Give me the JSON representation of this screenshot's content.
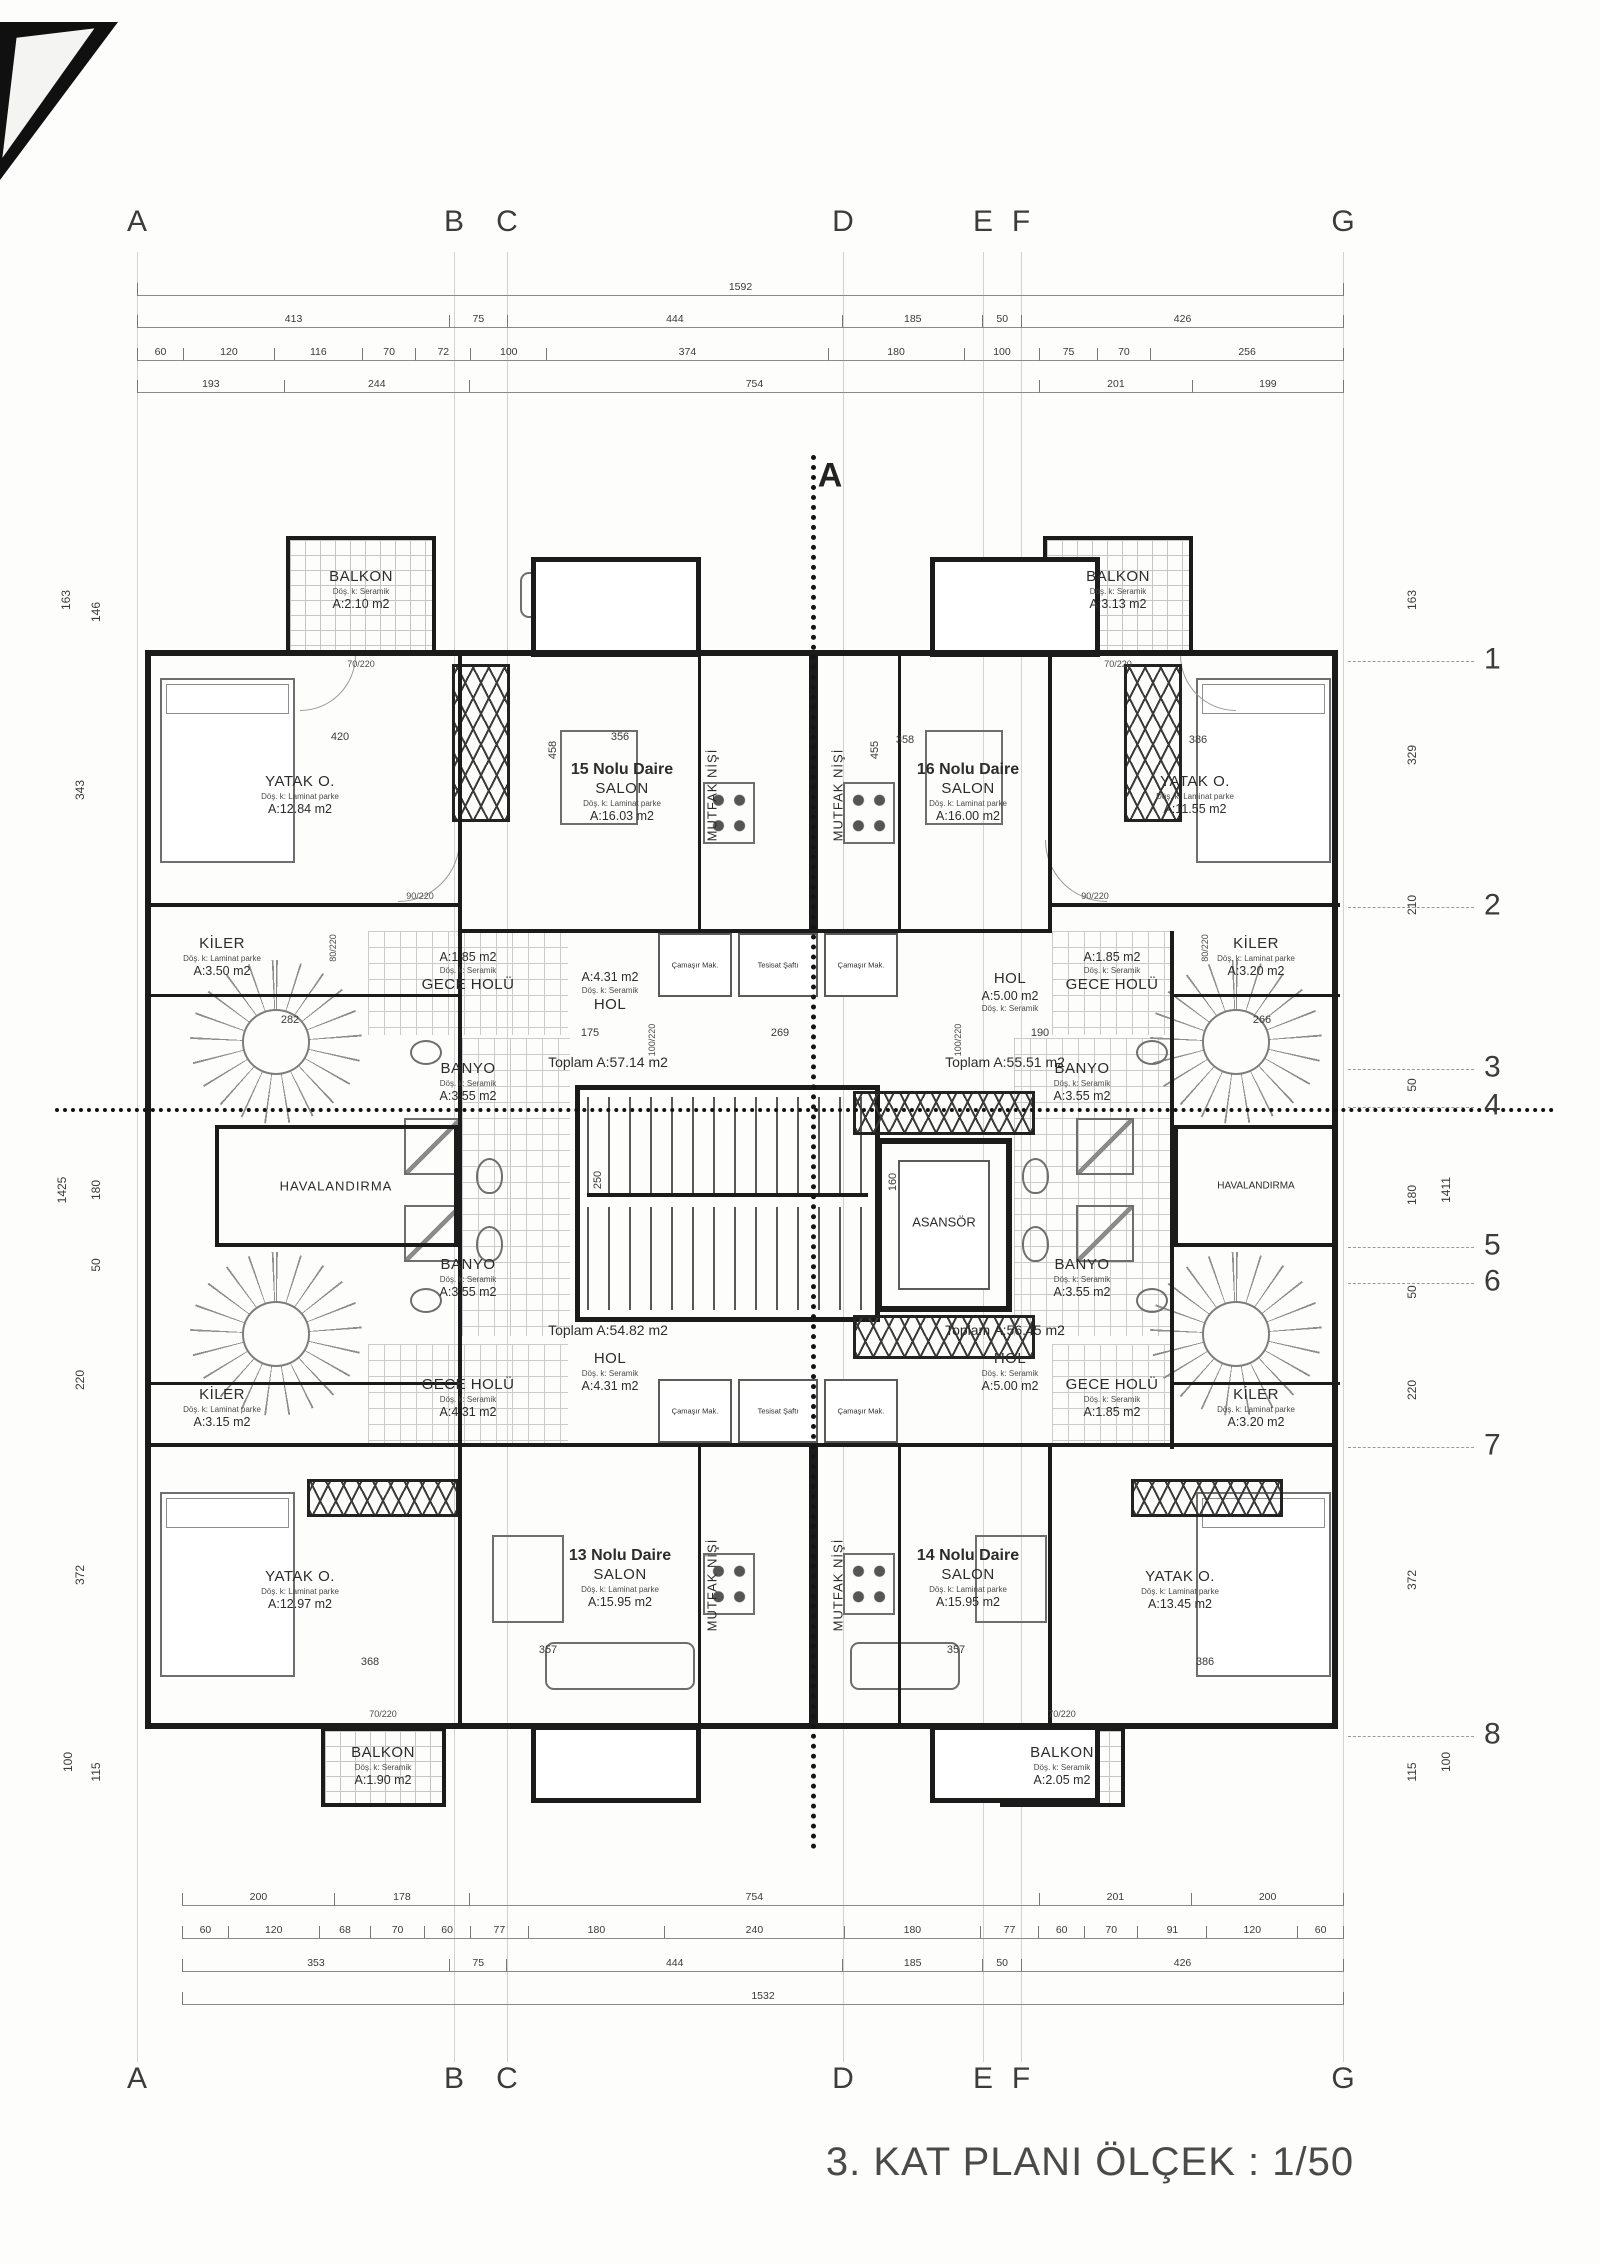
{
  "title": "3. KAT PLANI ÖLÇEK : 1/50",
  "section_marker": "A",
  "grid": {
    "columns": [
      "A",
      "B",
      "C",
      "D",
      "E",
      "F",
      "G"
    ],
    "rows": [
      "1",
      "2",
      "3",
      "4",
      "5",
      "6",
      "7",
      "8"
    ]
  },
  "dimensions": {
    "top": [
      [
        "1592"
      ],
      [
        "413",
        "75",
        "444",
        "185",
        "50",
        "426"
      ],
      [
        "60",
        "120",
        "116",
        "70",
        "72",
        "100",
        "374",
        "180",
        "100",
        "75",
        "70",
        "256"
      ],
      [
        "193",
        "244",
        "754",
        "201",
        "199"
      ]
    ],
    "bottom": [
      [
        "200",
        "178",
        "754",
        "201",
        "200"
      ],
      [
        "60",
        "120",
        "68",
        "70",
        "60",
        "77",
        "180",
        "240",
        "180",
        "77",
        "60",
        "70",
        "91",
        "120",
        "60"
      ],
      [
        "353",
        "75",
        "444",
        "185",
        "50",
        "426"
      ],
      [
        "1532"
      ]
    ],
    "left": [
      "163",
      "146",
      "343",
      "1425",
      "180",
      "50",
      "220",
      "372",
      "115",
      "100"
    ],
    "right": [
      "163",
      "329",
      "210",
      "50",
      "180",
      "1411",
      "50",
      "220",
      "372",
      "115",
      "100"
    ]
  },
  "inner_dims": {
    "d420": "420",
    "d356": "356",
    "d358": "358",
    "d386": "386",
    "d458": "458",
    "d455": "455",
    "d175": "175",
    "d269": "269",
    "d190": "190",
    "d282": "282",
    "d266": "266",
    "d250": "250",
    "d160": "160",
    "d357": "357",
    "d368": "368"
  },
  "doors": {
    "d70": "70/220",
    "d80": "80/220",
    "d90": "90/220",
    "d100": "100/220"
  },
  "labels": {
    "havalandirma": "HAVALANDIRMA",
    "asansor": "ASANSÖR",
    "mutfak": "MUTFAK NİŞİ",
    "camasir": "Çamaşır Mak.",
    "tesisat": "Tesisat Şaftı",
    "toplam_15": "Toplam A:57.14 m2",
    "toplam_16": "Toplam A:55.51 m2",
    "toplam_13": "Toplam A:54.82 m2",
    "toplam_14": "Toplam A:56.45 m2"
  },
  "rooms": {
    "balkon_tl": {
      "lines": [
        {
          "t": "BALKON",
          "s": "name"
        },
        {
          "t": "Döş. k: Seramik",
          "s": "note"
        },
        {
          "t": "A:2.10 m2",
          "s": "area"
        }
      ]
    },
    "balkon_tr": {
      "lines": [
        {
          "t": "BALKON",
          "s": "name"
        },
        {
          "t": "Döş. k: Seramik",
          "s": "note"
        },
        {
          "t": "A:3.13 m2",
          "s": "area"
        }
      ]
    },
    "balkon_bl": {
      "lines": [
        {
          "t": "BALKON",
          "s": "name"
        },
        {
          "t": "Döş. k: Seramik",
          "s": "note"
        },
        {
          "t": "A:1.90 m2",
          "s": "area"
        }
      ]
    },
    "balkon_br": {
      "lines": [
        {
          "t": "BALKON",
          "s": "name"
        },
        {
          "t": "Döş. k: Seramik",
          "s": "note"
        },
        {
          "t": "A:2.05 m2",
          "s": "area"
        }
      ]
    },
    "yatak_15": {
      "lines": [
        {
          "t": "YATAK O.",
          "s": "name"
        },
        {
          "t": "Döş. k: Laminat parke",
          "s": "note"
        },
        {
          "t": "A:12.84 m2",
          "s": "area"
        }
      ]
    },
    "yatak_16": {
      "lines": [
        {
          "t": "YATAK O.",
          "s": "name"
        },
        {
          "t": "Döş. k: Laminat parke",
          "s": "note"
        },
        {
          "t": "A:11.55 m2",
          "s": "area"
        }
      ]
    },
    "yatak_13": {
      "lines": [
        {
          "t": "YATAK O.",
          "s": "name"
        },
        {
          "t": "Döş. k: Laminat parke",
          "s": "note"
        },
        {
          "t": "A:12.97 m2",
          "s": "area"
        }
      ]
    },
    "yatak_14": {
      "lines": [
        {
          "t": "YATAK O.",
          "s": "name"
        },
        {
          "t": "Döş. k: Laminat parke",
          "s": "note"
        },
        {
          "t": "A:13.45 m2",
          "s": "area"
        }
      ]
    },
    "salon_15": {
      "lines": [
        {
          "t": "15 Nolu Daire",
          "s": "unit"
        },
        {
          "t": "SALON",
          "s": "name"
        },
        {
          "t": "Döş. k: Laminat parke",
          "s": "note"
        },
        {
          "t": "A:16.03 m2",
          "s": "area"
        }
      ]
    },
    "salon_16": {
      "lines": [
        {
          "t": "16 Nolu Daire",
          "s": "unit"
        },
        {
          "t": "SALON",
          "s": "name"
        },
        {
          "t": "Döş. k: Laminat parke",
          "s": "note"
        },
        {
          "t": "A:16.00 m2",
          "s": "area"
        }
      ]
    },
    "salon_13": {
      "lines": [
        {
          "t": "13 Nolu Daire",
          "s": "unit"
        },
        {
          "t": "SALON",
          "s": "name"
        },
        {
          "t": "Döş. k: Laminat parke",
          "s": "note"
        },
        {
          "t": "A:15.95 m2",
          "s": "area"
        }
      ]
    },
    "salon_14": {
      "lines": [
        {
          "t": "14 Nolu Daire",
          "s": "unit"
        },
        {
          "t": "SALON",
          "s": "name"
        },
        {
          "t": "Döş. k: Laminat parke",
          "s": "note"
        },
        {
          "t": "A:15.95 m2",
          "s": "area"
        }
      ]
    },
    "kiler_15": {
      "lines": [
        {
          "t": "KİLER",
          "s": "name"
        },
        {
          "t": "Döş. k: Laminat parke",
          "s": "note"
        },
        {
          "t": "A:3.50 m2",
          "s": "area"
        }
      ]
    },
    "kiler_16": {
      "lines": [
        {
          "t": "KİLER",
          "s": "name"
        },
        {
          "t": "Döş. k: Laminat parke",
          "s": "note"
        },
        {
          "t": "A:3.20 m2",
          "s": "area"
        }
      ]
    },
    "kiler_13": {
      "lines": [
        {
          "t": "KİLER",
          "s": "name"
        },
        {
          "t": "Döş. k: Laminat parke",
          "s": "note"
        },
        {
          "t": "A:3.15 m2",
          "s": "area"
        }
      ]
    },
    "kiler_14": {
      "lines": [
        {
          "t": "KİLER",
          "s": "name"
        },
        {
          "t": "Döş. k: Laminat parke",
          "s": "note"
        },
        {
          "t": "A:3.20 m2",
          "s": "area"
        }
      ]
    },
    "gece_15": {
      "lines": [
        {
          "t": "A:1.85 m2",
          "s": "area"
        },
        {
          "t": "Döş. k: Seramik",
          "s": "note"
        },
        {
          "t": "GECE HOLÜ",
          "s": "name"
        }
      ]
    },
    "gece_16": {
      "lines": [
        {
          "t": "A:1.85 m2",
          "s": "area"
        },
        {
          "t": "Döş. k: Seramik",
          "s": "note"
        },
        {
          "t": "GECE HOLÜ",
          "s": "name"
        }
      ]
    },
    "gece_13": {
      "lines": [
        {
          "t": "GECE HOLÜ",
          "s": "name"
        },
        {
          "t": "Döş. k: Seramik",
          "s": "note"
        },
        {
          "t": "A:4.31 m2",
          "s": "area"
        }
      ]
    },
    "gece_14": {
      "lines": [
        {
          "t": "GECE HOLÜ",
          "s": "name"
        },
        {
          "t": "Döş. k: Seramik",
          "s": "note"
        },
        {
          "t": "A:1.85 m2",
          "s": "area"
        }
      ]
    },
    "hol_15": {
      "lines": [
        {
          "t": "A:4.31 m2",
          "s": "area"
        },
        {
          "t": "Döş. k: Seramik",
          "s": "note"
        },
        {
          "t": "HOL",
          "s": "name"
        }
      ]
    },
    "hol_16": {
      "lines": [
        {
          "t": "HOL",
          "s": "name"
        },
        {
          "t": "A:5.00 m2",
          "s": "area"
        },
        {
          "t": "Döş. k: Seramik",
          "s": "note"
        }
      ]
    },
    "hol_13": {
      "lines": [
        {
          "t": "HOL",
          "s": "name"
        },
        {
          "t": "Döş. k: Seramik",
          "s": "note"
        },
        {
          "t": "A:4.31 m2",
          "s": "area"
        }
      ]
    },
    "hol_14": {
      "lines": [
        {
          "t": "HOL",
          "s": "name"
        },
        {
          "t": "Döş. k: Seramik",
          "s": "note"
        },
        {
          "t": "A:5.00 m2",
          "s": "area"
        }
      ]
    },
    "banyo_15": {
      "lines": [
        {
          "t": "BANYO",
          "s": "name"
        },
        {
          "t": "Döş. k: Seramik",
          "s": "note"
        },
        {
          "t": "A:3.55 m2",
          "s": "area"
        }
      ]
    },
    "banyo_16": {
      "lines": [
        {
          "t": "BANYO",
          "s": "name"
        },
        {
          "t": "Döş. k: Seramik",
          "s": "note"
        },
        {
          "t": "A:3.55 m2",
          "s": "area"
        }
      ]
    },
    "banyo_13": {
      "lines": [
        {
          "t": "BANYO",
          "s": "name"
        },
        {
          "t": "Döş. k: Seramik",
          "s": "note"
        },
        {
          "t": "A:3.55 m2",
          "s": "area"
        }
      ]
    },
    "banyo_14": {
      "lines": [
        {
          "t": "BANYO",
          "s": "name"
        },
        {
          "t": "Döş. k: Seramik",
          "s": "note"
        },
        {
          "t": "A:3.55 m2",
          "s": "area"
        }
      ]
    }
  }
}
